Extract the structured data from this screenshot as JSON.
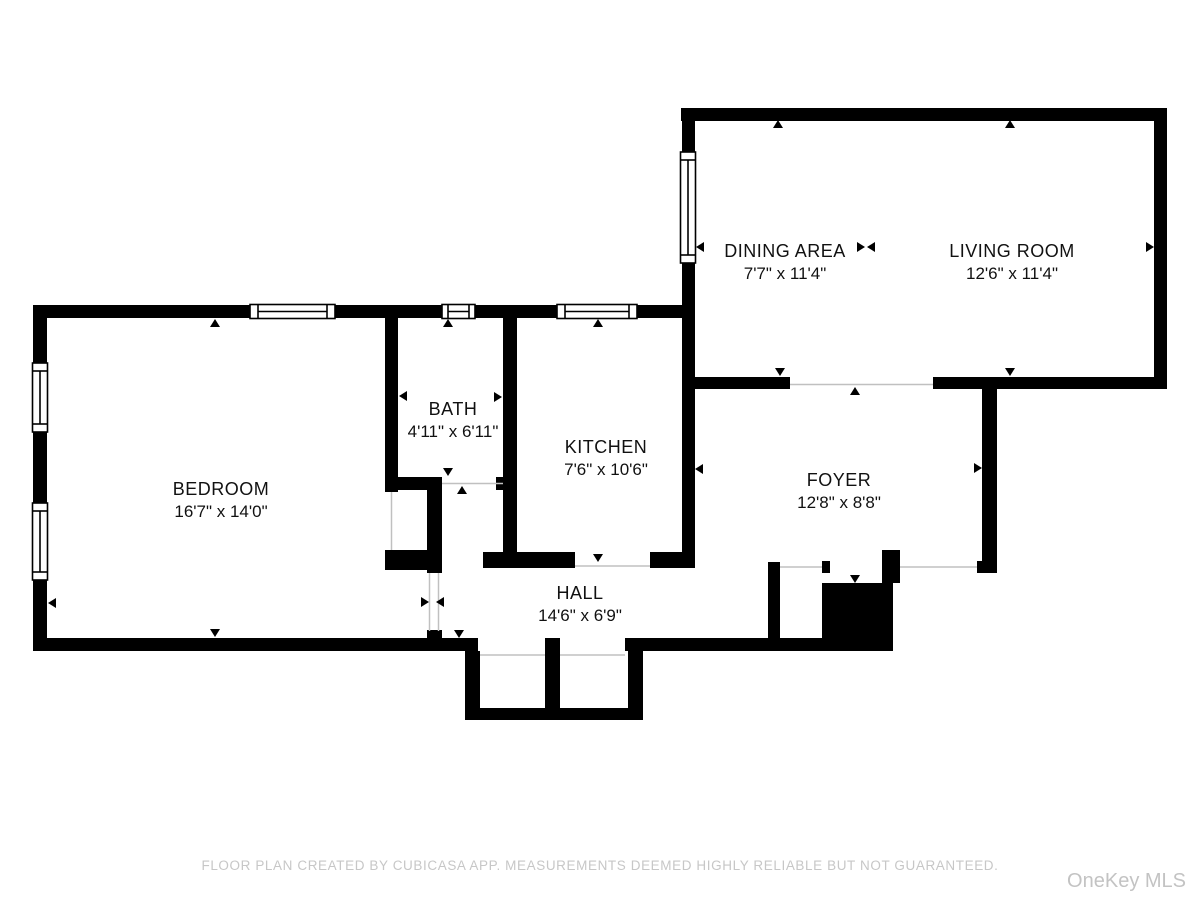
{
  "rooms": [
    {
      "name": "DINING AREA",
      "dims": "7'7\" x 11'4\""
    },
    {
      "name": "LIVING ROOM",
      "dims": "12'6\" x 11'4\""
    },
    {
      "name": "BEDROOM",
      "dims": "16'7\" x 14'0\""
    },
    {
      "name": "BATH",
      "dims": "4'11\" x 6'11\""
    },
    {
      "name": "KITCHEN",
      "dims": "7'6\" x 10'6\""
    },
    {
      "name": "FOYER",
      "dims": "12'8\" x 8'8\""
    },
    {
      "name": "HALL",
      "dims": "14'6\" x 6'9\""
    }
  ],
  "footer": {
    "disclaimer": "FLOOR PLAN CREATED BY CUBICASA APP. MEASUREMENTS DEEMED HIGHLY RELIABLE BUT NOT GUARANTEED.",
    "watermark": "OneKey MLS"
  },
  "colors": {
    "wall": "#000000",
    "background": "#ffffff",
    "threshold_line": "#c0c0c0",
    "label_text": "#111111",
    "footer_text": "#c7c7c7",
    "watermark_text": "#c3c3c3"
  }
}
